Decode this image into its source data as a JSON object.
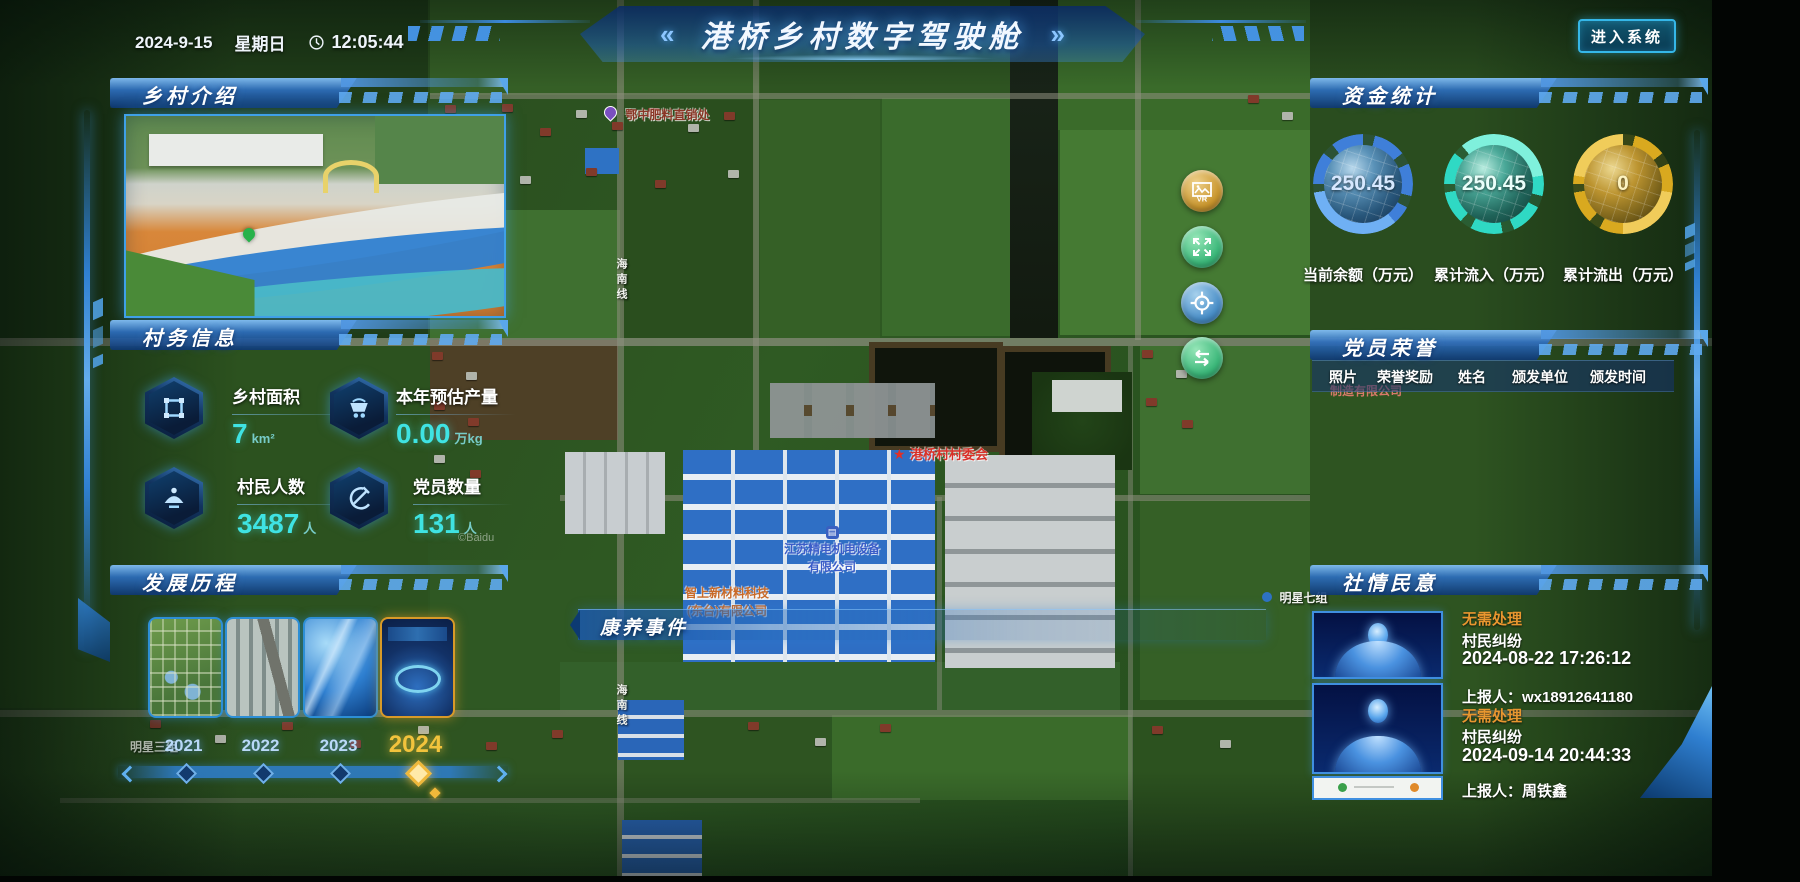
{
  "header": {
    "date": "2024-9-15",
    "weekday": "星期日",
    "time": "12:05:44",
    "left_chevron": "«",
    "title": "港桥乡村数字驾驶舱",
    "right_chevron": "»",
    "enter_button": "进入系统"
  },
  "intro_panel": {
    "title": "乡村介绍"
  },
  "affairs_panel": {
    "title": "村务信息",
    "stats": [
      {
        "label": "乡村面积",
        "value": "7",
        "unit": "km²",
        "icon": "area-icon"
      },
      {
        "label": "本年预估产量",
        "value": "0.00",
        "unit": "万kg",
        "icon": "cart-icon"
      },
      {
        "label": "村民人数",
        "value": "3487",
        "unit": "人",
        "icon": "people-icon"
      },
      {
        "label": "党员数量",
        "value": "131",
        "unit": "人",
        "icon": "party-icon"
      }
    ]
  },
  "history_panel": {
    "title": "发展历程",
    "items": [
      {
        "year": "2021",
        "selected": false
      },
      {
        "year": "2022",
        "selected": false
      },
      {
        "year": "2023",
        "selected": false
      },
      {
        "year": "2024",
        "selected": true
      }
    ]
  },
  "funds_panel": {
    "title": "资金统计",
    "gauges": [
      {
        "value": "250.45",
        "label": "当前余额（万元）",
        "color": "#3f7fd9"
      },
      {
        "value": "250.45",
        "label": "累计流入（万元）",
        "color": "#2fd9c4"
      },
      {
        "value": "0",
        "label": "累计流出（万元）",
        "color": "#d9a91f"
      }
    ]
  },
  "honors_panel": {
    "title": "党员荣誉",
    "columns": [
      "照片",
      "荣誉奖励",
      "姓名",
      "颁发单位",
      "颁发时间"
    ]
  },
  "sentiment_panel": {
    "title": "社情民意",
    "items": [
      {
        "status": "无需处理",
        "category": "村民纠纷",
        "datetime": "2024-08-22 17:26:12",
        "reporter": "上报人：wx18912641180"
      },
      {
        "status": "无需处理",
        "category": "村民纠纷",
        "datetime": "2024-09-14 20:44:33",
        "reporter": "上报人：周铁鑫"
      }
    ]
  },
  "events_bar": {
    "title": "康养事件"
  },
  "map": {
    "labels": {
      "fertilizer": "鄂中肥料直销处",
      "committee": "港桥村村委会",
      "company_jingdian_line1": "江苏精电机电设备",
      "company_jingdian_line2": "有限公司",
      "company_zhishang_line1": "智上新材料科技",
      "company_zhishang_line2": "(东台)有限公司",
      "company_pink": "制造有限公司",
      "mingxing7": "明星七组",
      "mingxing3": "明星三组",
      "road": "海南线",
      "watermark": "©Baidu"
    },
    "controls": [
      {
        "name": "vr-panorama",
        "label": "VR"
      },
      {
        "name": "fullscreen"
      },
      {
        "name": "locate"
      },
      {
        "name": "layers-swap"
      }
    ]
  }
}
